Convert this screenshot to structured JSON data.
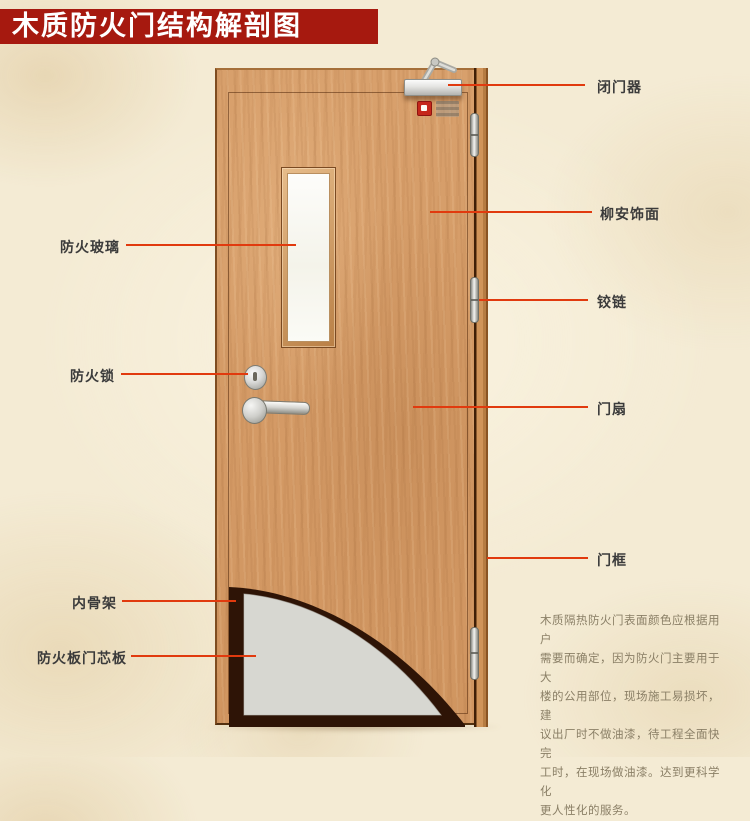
{
  "title": "木质防火门结构解剖图",
  "labels": {
    "left": [
      {
        "id": "fire-glass",
        "text": "防火玻璃"
      },
      {
        "id": "fire-lock",
        "text": "防火锁"
      },
      {
        "id": "inner-skeleton",
        "text": "内骨架"
      },
      {
        "id": "fire-board-core",
        "text": "防火板门芯板"
      }
    ],
    "right": [
      {
        "id": "door-closer",
        "text": "闭门器"
      },
      {
        "id": "lauan-veneer",
        "text": "柳安饰面"
      },
      {
        "id": "hinge",
        "text": "铰链"
      },
      {
        "id": "door-leaf",
        "text": "门扇"
      },
      {
        "id": "door-frame",
        "text": "门框"
      }
    ]
  },
  "description": {
    "lines": [
      "木质隔热防火门表面颜色应根据用户",
      "需要而确定，因为防火门主要用于大",
      "楼的公用部位，现场施工易损坏，建",
      "议出厂时不做油漆，待工程全面快完",
      "工时，在现场做油漆。达到更科学化",
      "更人性化的服务。"
    ]
  },
  "colors": {
    "banner": "#a6190f",
    "leader_line": "#e13a0e",
    "wood": "#d49b66",
    "frame_wood": "#b67c42",
    "core_panel": "#d7d7d1",
    "skeleton": "#2e1406",
    "background": "#f4ebd4"
  }
}
